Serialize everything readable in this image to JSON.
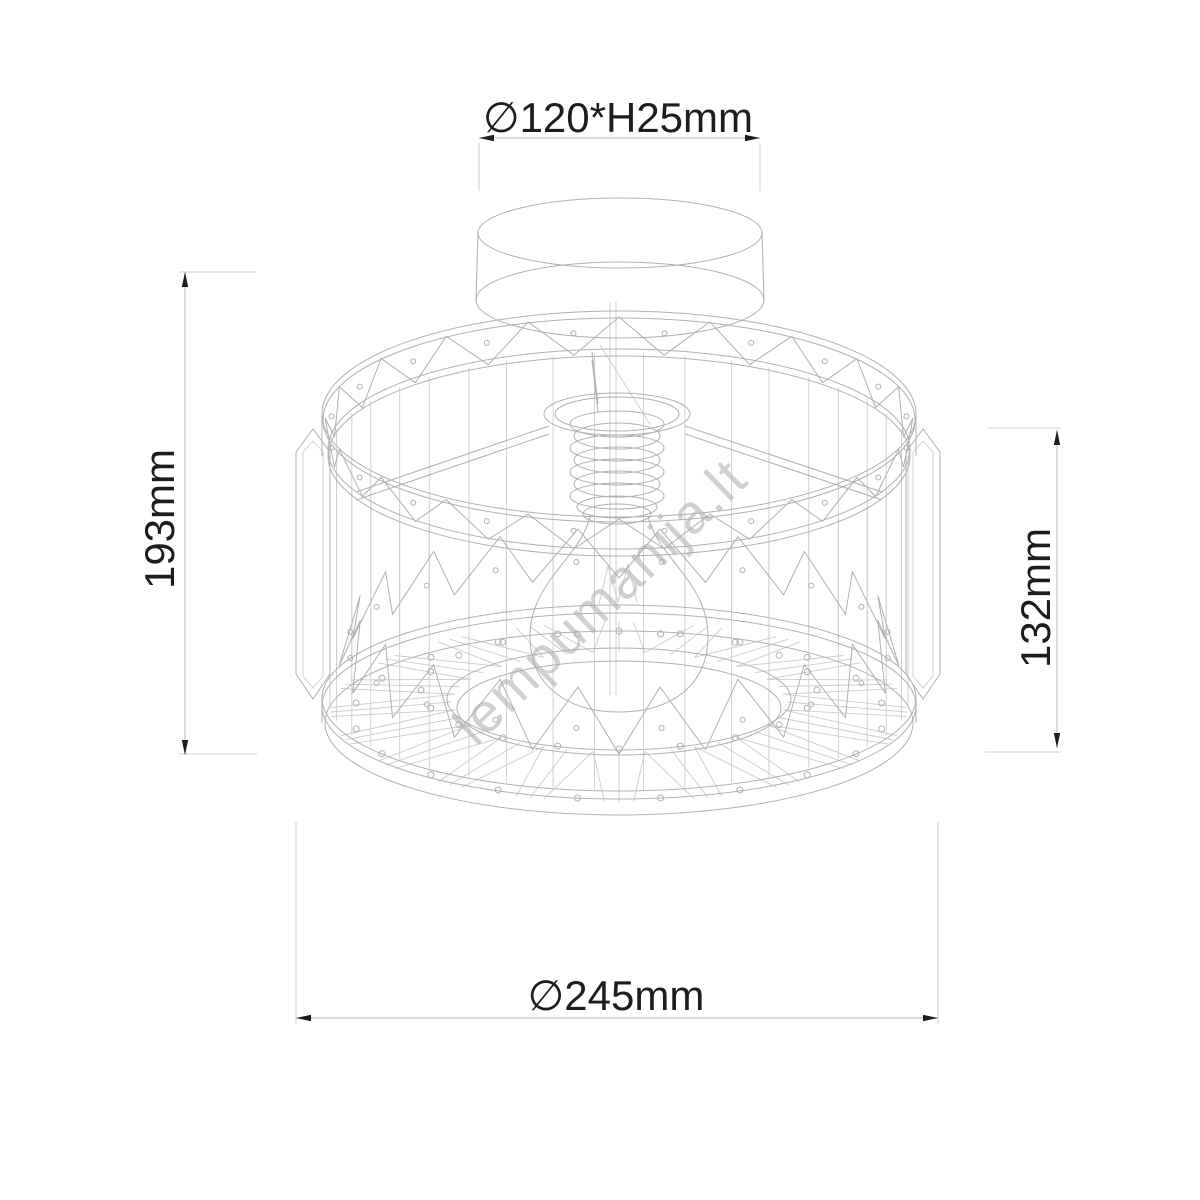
{
  "drawing": {
    "type": "wireframe technical drawing",
    "subject": "crystal drum ceiling light fixture with exposed bulb",
    "background": "#ffffff"
  },
  "watermark": {
    "text": "lempumanija.lt",
    "color": "#ababab"
  },
  "dimensions": {
    "canopy": {
      "label": "∅120*H25mm"
    },
    "overall_height": {
      "label": "193mm"
    },
    "shade_height": {
      "label": "132mm"
    },
    "shade_diameter": {
      "label": "∅245mm"
    }
  },
  "colors": {
    "line_light": "#cccccc",
    "line_mid": "#b0b0b0",
    "dim_line": "#c6c6c6",
    "ext_line": "#d2d2d2",
    "arrow": "#1d1d1d",
    "text": "#1d1d1d"
  }
}
